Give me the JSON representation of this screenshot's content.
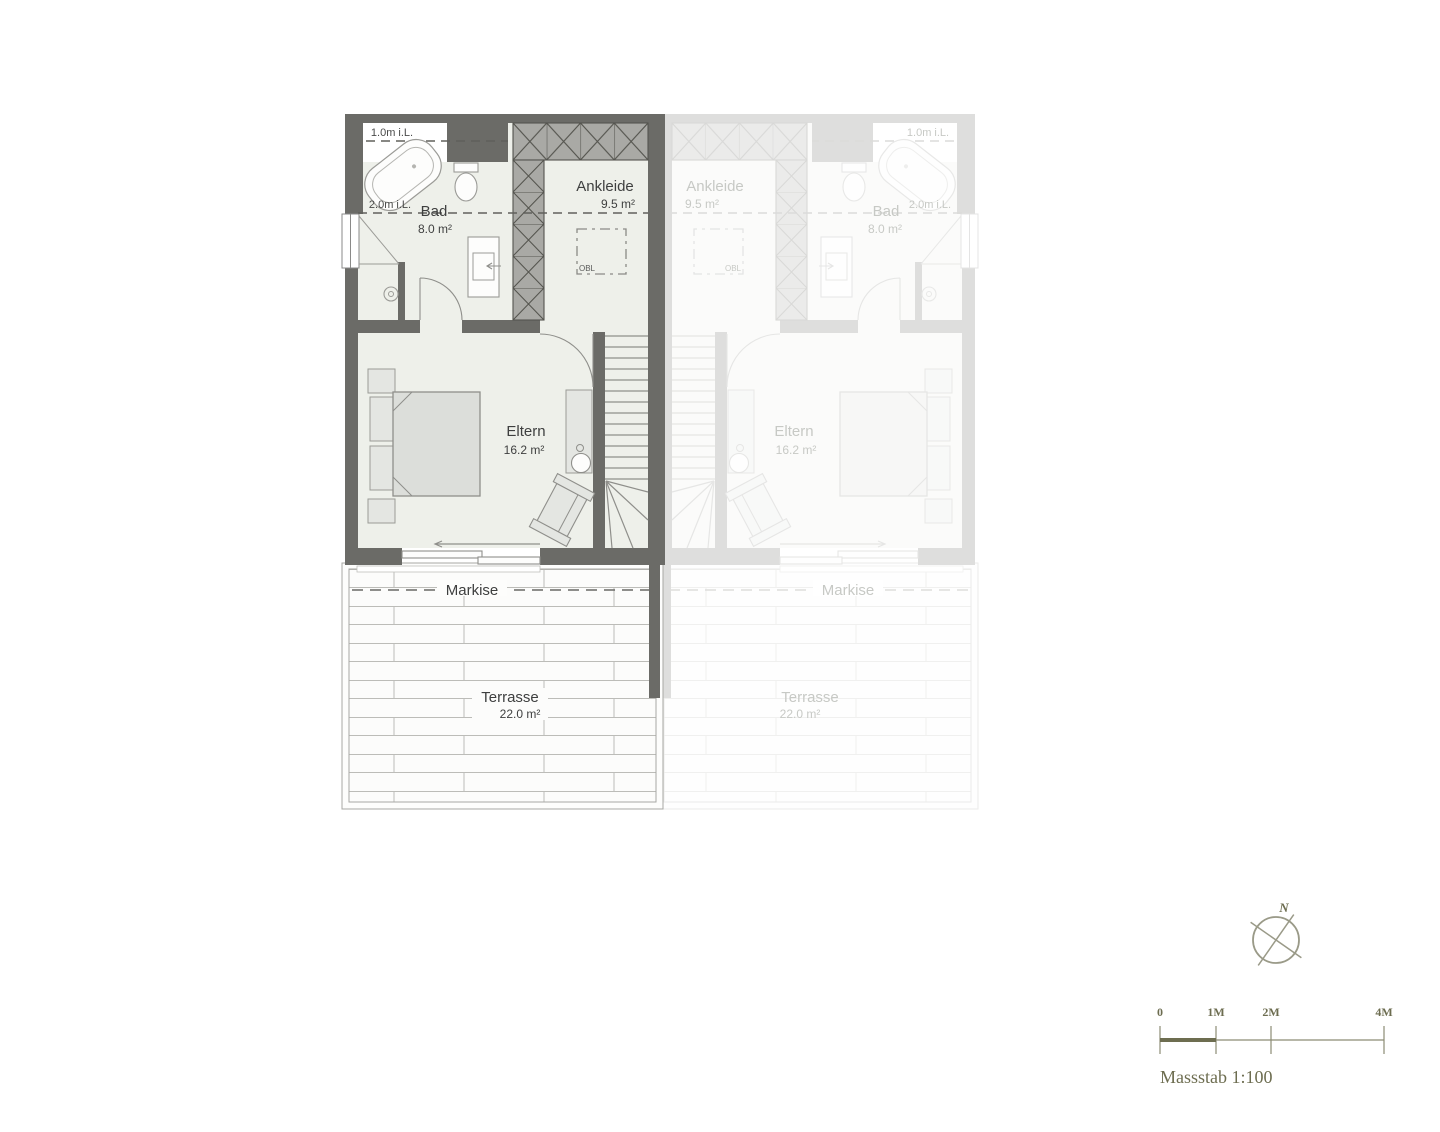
{
  "units": {
    "active": {
      "bad": {
        "name": "Bad",
        "area": "8.0 m²"
      },
      "ankleide": {
        "name": "Ankleide",
        "area": "9.5 m²"
      },
      "eltern": {
        "name": "Eltern",
        "area": "16.2 m²"
      },
      "terrasse": {
        "name": "Terrasse",
        "area": "22.0 m²"
      },
      "markise": "Markise",
      "clearance_top": "1.0m i.L.",
      "clearance_mid": "2.0m i.L.",
      "skylight": "OBL"
    },
    "neighbor": {
      "bad": {
        "name": "Bad",
        "area": "8.0 m²"
      },
      "ankleide": {
        "name": "Ankleide",
        "area": "9.5 m²"
      },
      "eltern": {
        "name": "Eltern",
        "area": "16.2 m²"
      },
      "terrasse": {
        "name": "Terrasse",
        "area": "22.0 m²"
      },
      "markise": "Markise",
      "clearance_top": "1.0m i.L.",
      "clearance_mid": "2.0m i.L.",
      "skylight": "OBL"
    }
  },
  "compass": {
    "north": "N"
  },
  "scalebar": {
    "ticks": [
      "0",
      "1M",
      "2M",
      "4M"
    ],
    "caption": "Massstab 1:100"
  },
  "colors": {
    "wall": "#6b6b67",
    "floor": "#eef0ea",
    "hatch": "#a9a9a5",
    "furniture": "#e4e6e2",
    "faded_text": "#c7c9c5",
    "olive_accent": "#6d6d50",
    "text": "#3e3f3f"
  }
}
